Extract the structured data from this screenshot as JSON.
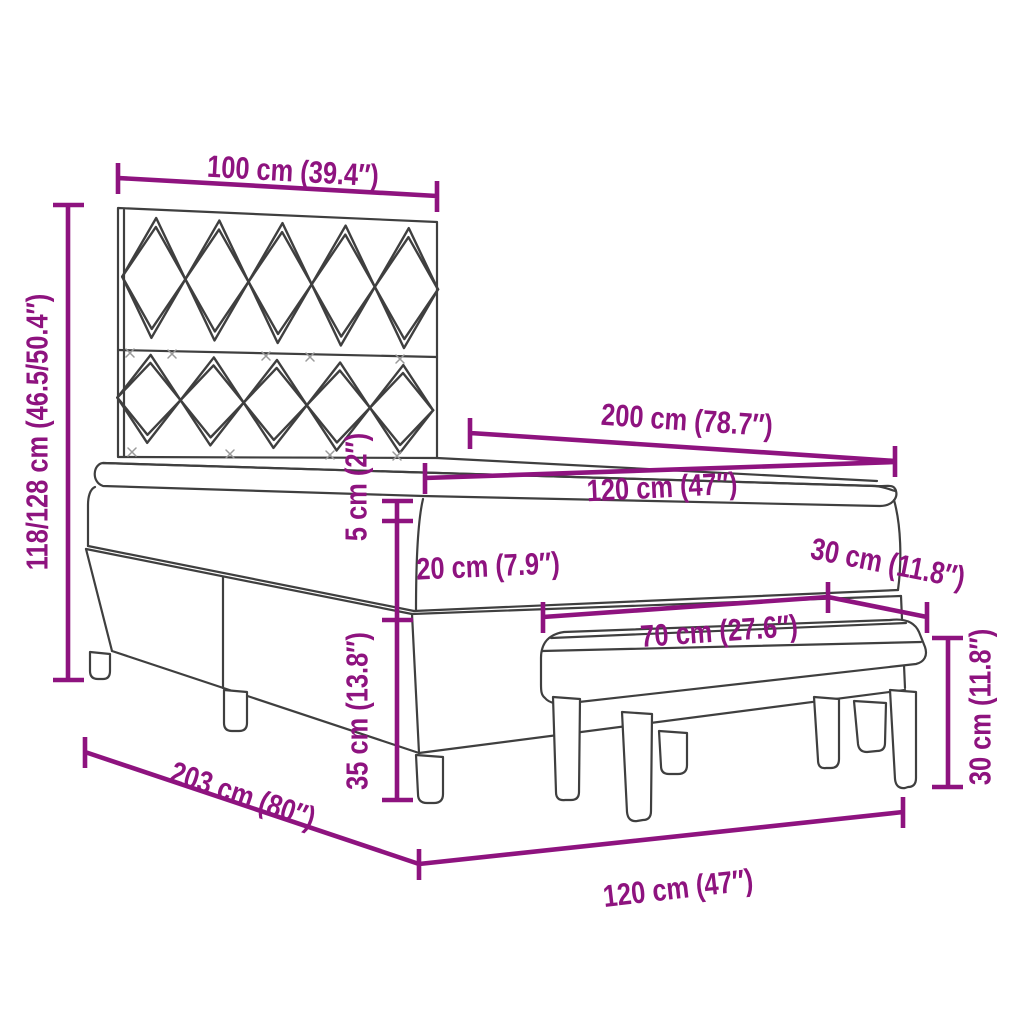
{
  "figure": {
    "type": "furniture-dimension-diagram",
    "subject": "box spring bed with chevron headboard, mattress topper and upholstered bench",
    "accent_color": "#8E137F",
    "outline_color": "#3F3F3F",
    "background_color": "#FFFFFF"
  },
  "labels": {
    "headboard_width": "100 cm (39.4″)",
    "overall_height": "118/128 cm (46.5/50.4″)",
    "bed_length": "200 cm (78.7″)",
    "bed_width": "120 cm (47″)",
    "topper_thickness": "5 cm (2″)",
    "mattress_thickness": "20 cm (7.9″)",
    "base_height": "35 cm (13.8″)",
    "bench_depth": "30 cm (11.8″)",
    "bench_length": "70 cm (27.6″)",
    "bench_height": "30 cm (11.8″)",
    "overall_length": "203 cm (80″)",
    "bed_width_bottom": "120 cm (47″)"
  }
}
